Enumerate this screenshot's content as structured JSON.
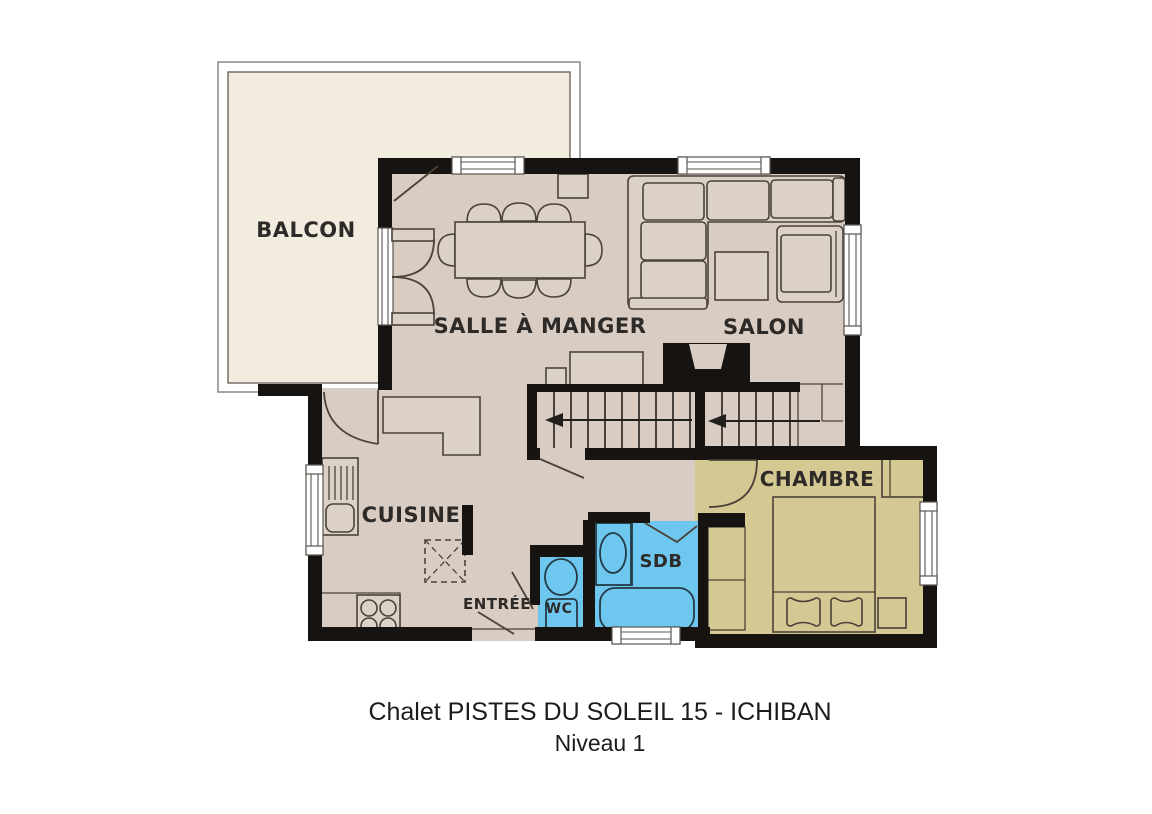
{
  "title": {
    "line1": "Chalet PISTES DU SOLEIL 15 - ICHIBAN",
    "line2": "Niveau 1"
  },
  "rooms": {
    "balcony": {
      "label": "BALCON"
    },
    "dining": {
      "label": "SALLE À MANGER"
    },
    "living": {
      "label": "SALON"
    },
    "kitchen": {
      "label": "CUISINE"
    },
    "entry": {
      "label": "ENTRÉE"
    },
    "wc": {
      "label": "WC"
    },
    "bathroom": {
      "label": "SDB"
    },
    "bedroom": {
      "label": "CHAMBRE"
    }
  },
  "colors": {
    "floor": "#d9ccc3",
    "balcony": "#f2ecdf",
    "bedroom": "#d5c993",
    "water": "#6ec7ee",
    "wall": "#171310",
    "text": "#2d2a27",
    "title": "#1c1c1c"
  }
}
